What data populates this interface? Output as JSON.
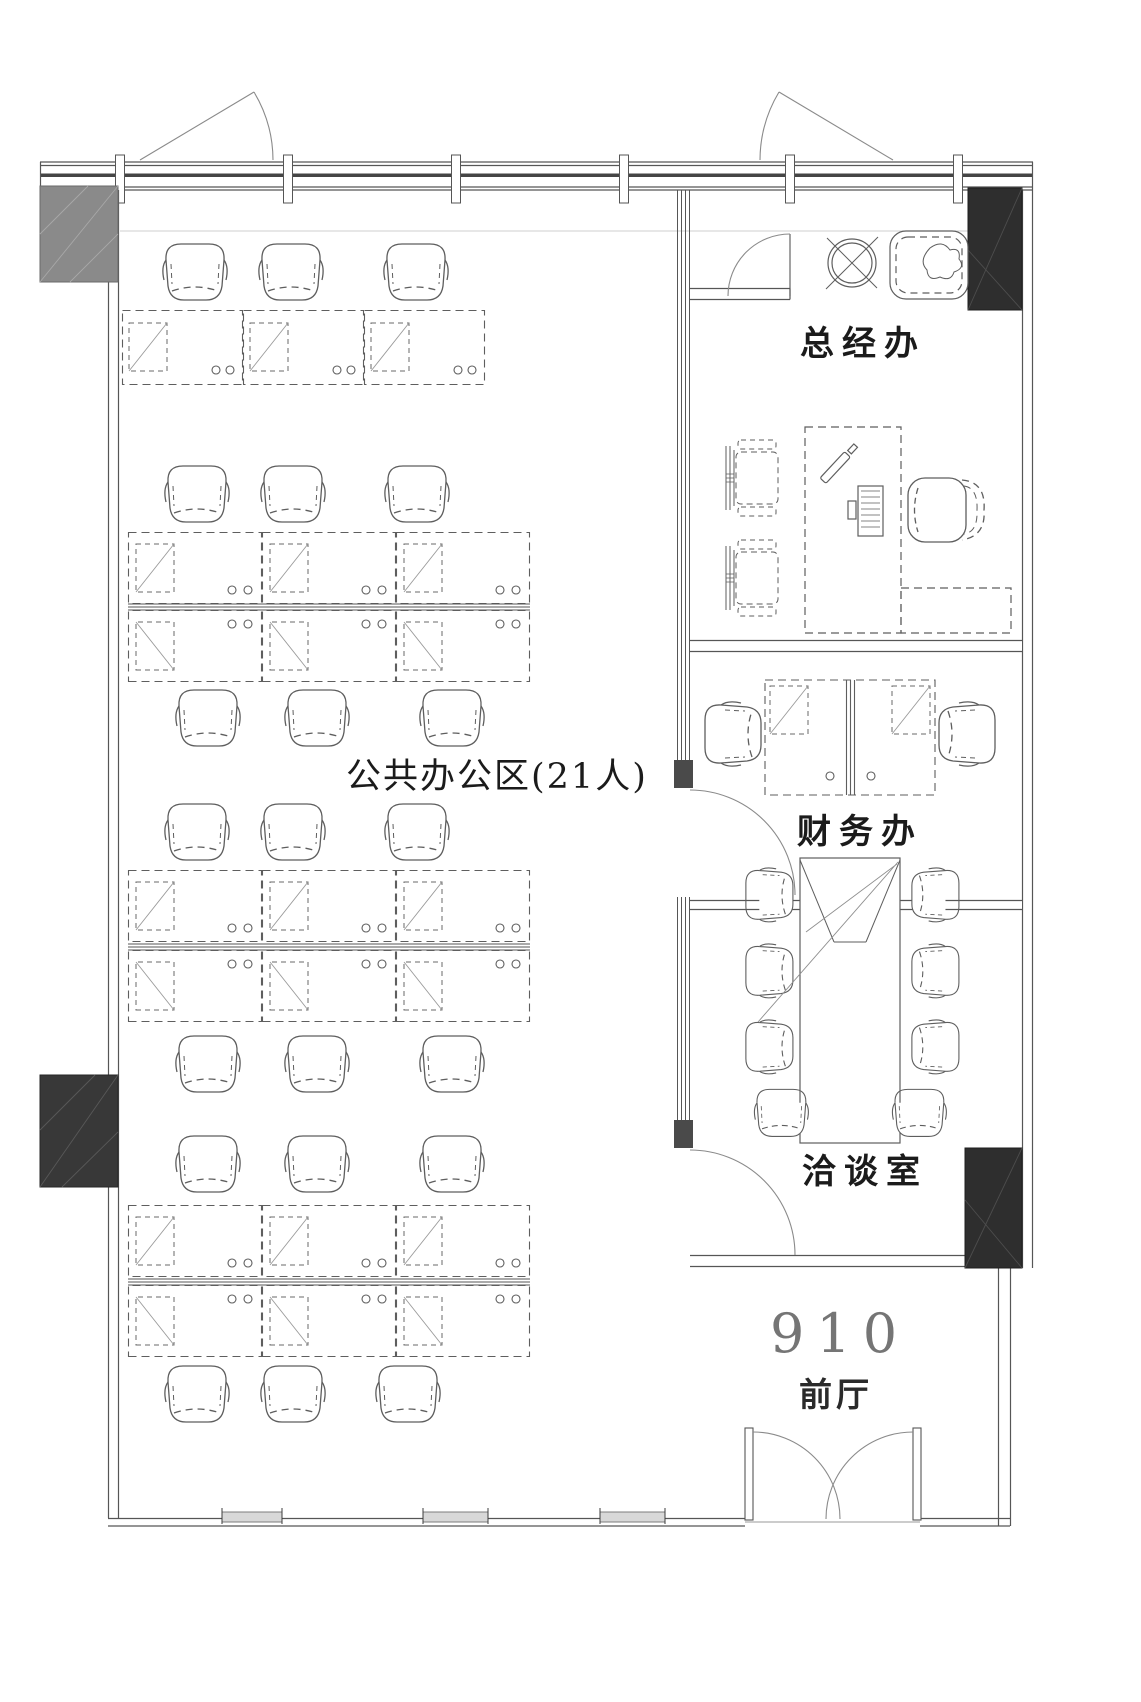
{
  "floor_plan": {
    "rooms": [
      {
        "id": "open-office",
        "label": "公共办公区(21人)"
      },
      {
        "id": "general-manager-office",
        "label": "总经办"
      },
      {
        "id": "finance-office",
        "label": "财务办"
      },
      {
        "id": "meeting-room",
        "label": "洽谈室"
      },
      {
        "id": "lobby",
        "label": "前厅"
      }
    ],
    "room_number": "910"
  },
  "colors": {
    "wall": "#4f4f4f",
    "furniture_line": "#5e5e5e",
    "light_line": "#cfcfcf",
    "column_gray": "#8a8a8a",
    "column_dark": "#2e2e2e",
    "label_text": "#1b1b1b",
    "room_number_text": "#757575",
    "background": "#ffffff"
  }
}
